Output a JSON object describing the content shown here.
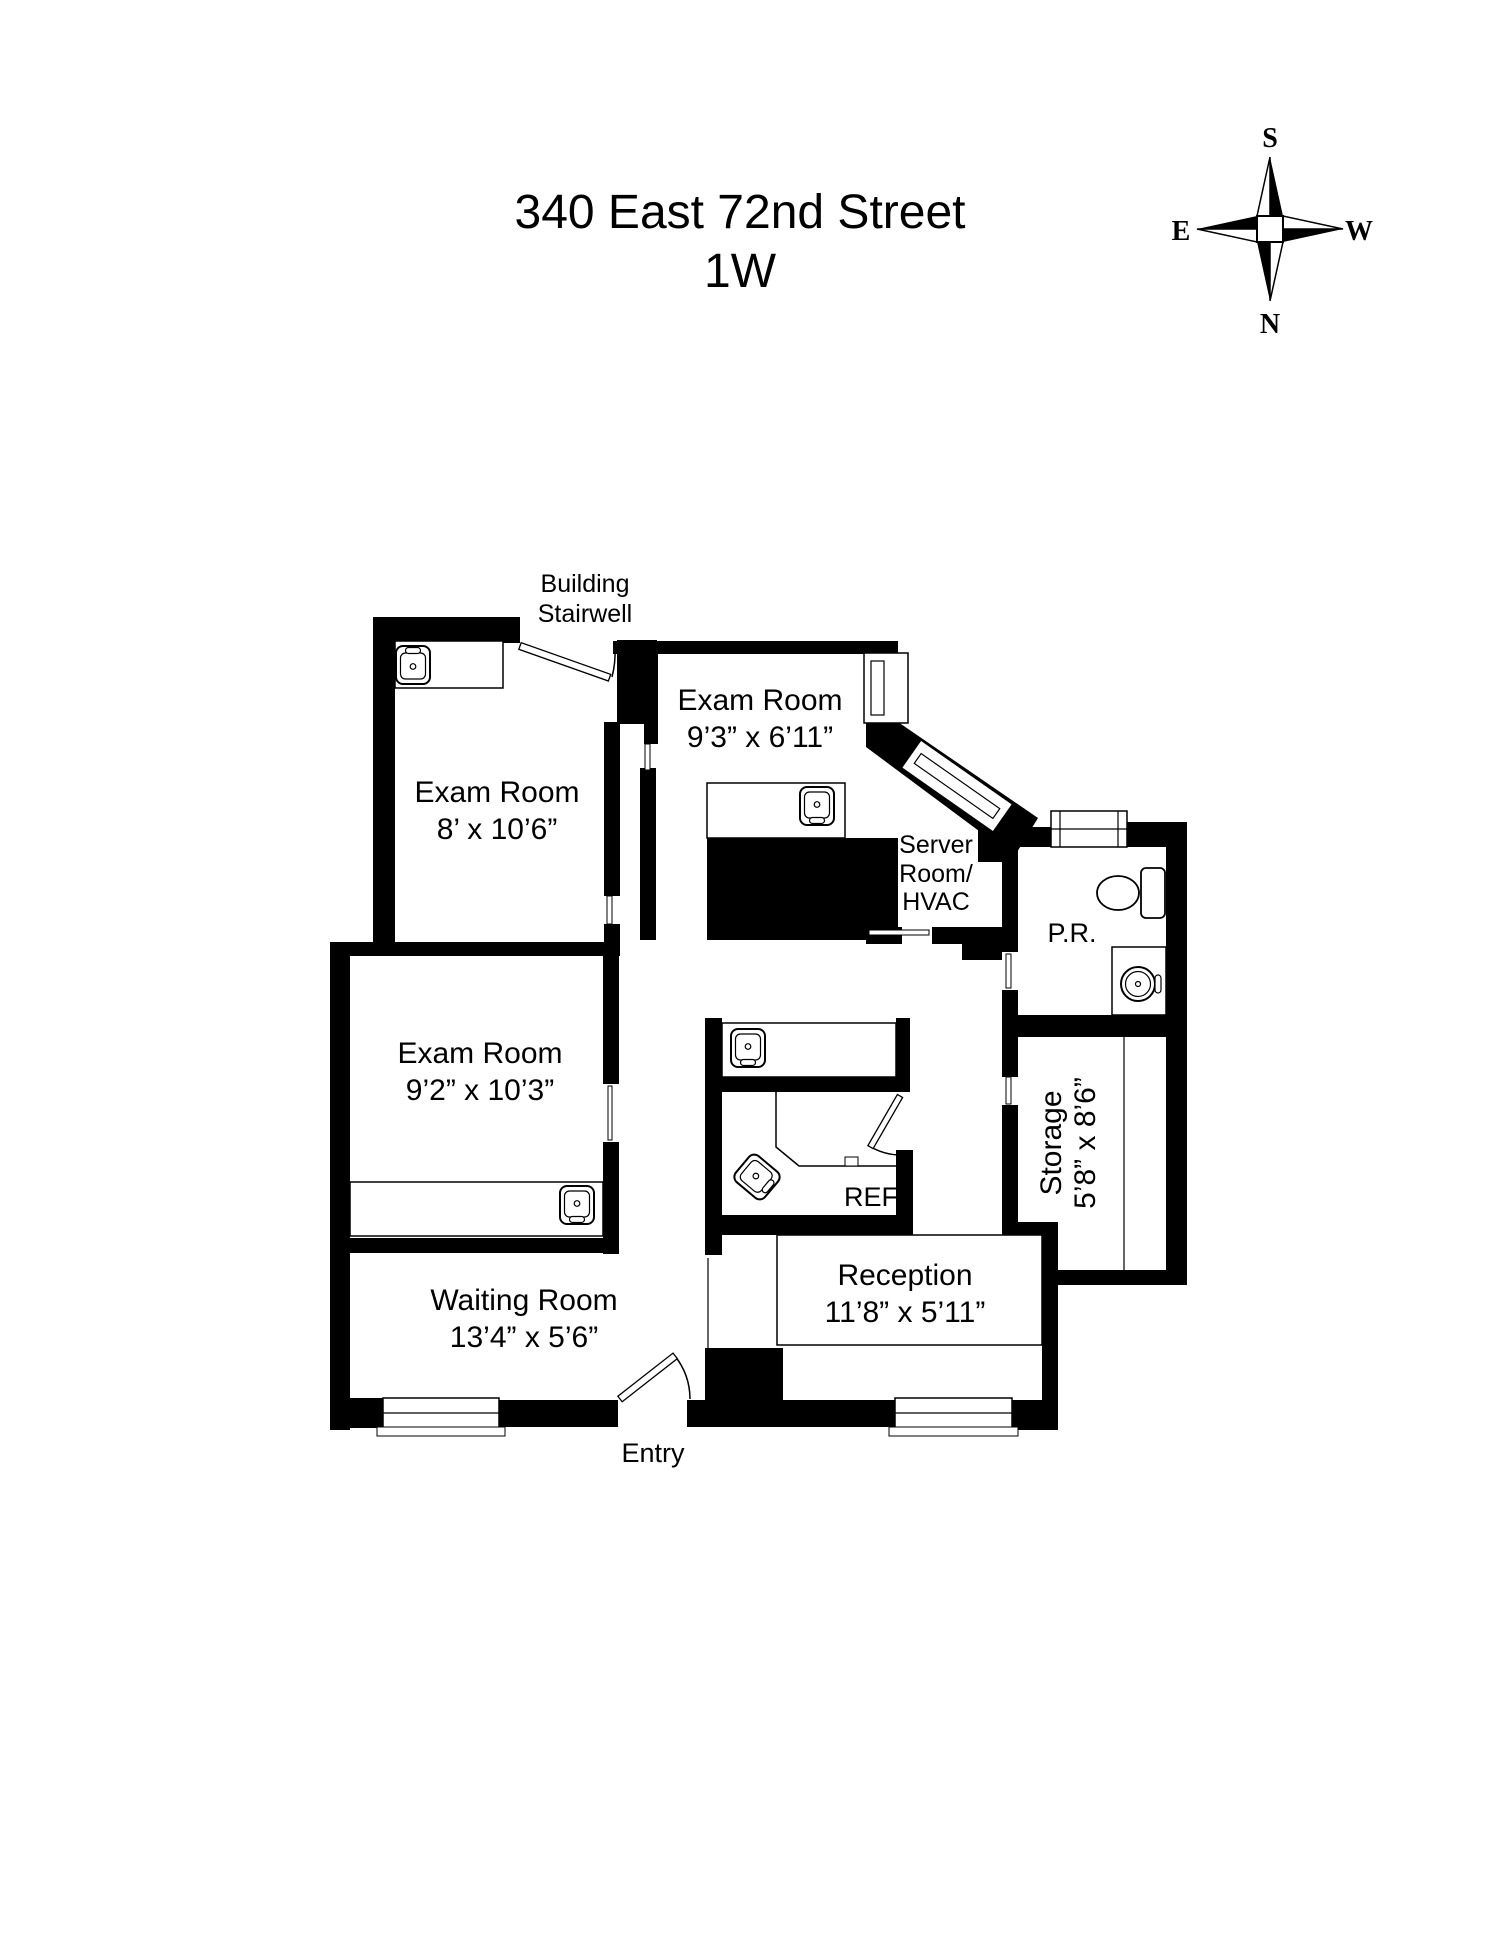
{
  "title": {
    "line1": "340 East 72nd Street",
    "line2": "1W"
  },
  "compass": {
    "top": "S",
    "bottom": "N",
    "left": "E",
    "right": "W"
  },
  "annotations": {
    "building_stairwell_line1": "Building",
    "building_stairwell_line2": "Stairwell",
    "entry": "Entry",
    "ref": "REF"
  },
  "rooms": {
    "exam_top_left": {
      "name": "Exam Room",
      "dims": "8’ x 10’6”"
    },
    "exam_top_middle": {
      "name": "Exam Room",
      "dims": "9’3” x 6’11”"
    },
    "exam_middle_left": {
      "name": "Exam Room",
      "dims": "9’2” x 10’3”"
    },
    "server_room": {
      "line1": "Server",
      "line2": "Room/",
      "line3": "HVAC"
    },
    "powder_room": {
      "name": "P.R."
    },
    "storage": {
      "name": "Storage",
      "dims": "5’8” x 8’6”"
    },
    "reception": {
      "name": "Reception",
      "dims": "11’8” x 5’11”"
    },
    "waiting_room": {
      "name": "Waiting Room",
      "dims": "13’4” x 5’6”"
    }
  },
  "icons": {
    "compass": "compass-rose-icon",
    "sink": "sink-icon",
    "toilet": "toilet-icon",
    "door": "door-swing-icon",
    "window": "window-icon"
  },
  "colors": {
    "wall": "#000000",
    "background": "#ffffff"
  }
}
